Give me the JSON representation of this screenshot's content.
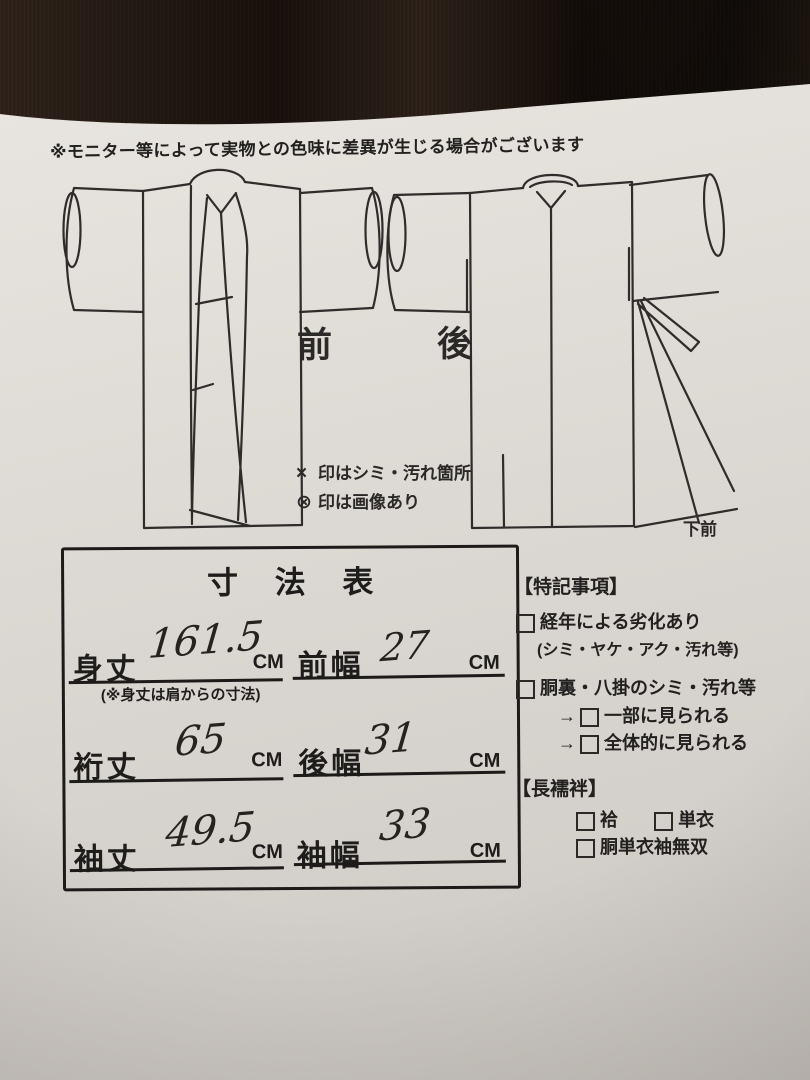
{
  "colors": {
    "paper": "#dedad5",
    "ink": "#222222",
    "fabric": "#241a14"
  },
  "disclaimer": "※モニター等によって実物との色味に差異が生じる場合がございます",
  "diagram": {
    "front_label": "前",
    "back_label": "後",
    "lower_front_label": "下前",
    "legend": [
      {
        "symbol": "×",
        "text": "印はシミ・汚れ箇所"
      },
      {
        "symbol": "⊗",
        "text": "印は画像あり"
      }
    ]
  },
  "size_table": {
    "title": "寸 法 表",
    "rows": [
      {
        "left_label": "身丈",
        "left_value": "161.5",
        "left_unit": "CM",
        "note": "(※身丈は肩からの寸法)",
        "right_label": "前幅",
        "right_value": "27",
        "right_unit": "CM"
      },
      {
        "left_label": "裄丈",
        "left_value": "65",
        "left_unit": "CM",
        "right_label": "後幅",
        "right_value": "31",
        "right_unit": "CM"
      },
      {
        "left_label": "袖丈",
        "left_value": "49.5",
        "left_unit": "CM",
        "right_label": "袖幅",
        "right_value": "33",
        "right_unit": "CM"
      }
    ]
  },
  "special_notes": {
    "title": "【特記事項】",
    "item1": {
      "label": "経年による劣化あり",
      "detail": "(シミ・ヤケ・アク・汚れ等)"
    },
    "item2": {
      "label": "胴裏・八掛のシミ・汚れ等",
      "options": [
        {
          "arrow": "→",
          "label": "一部に見られる"
        },
        {
          "arrow": "→",
          "label": "全体的に見られる"
        }
      ]
    }
  },
  "nagajuban": {
    "title": "【長襦袢】",
    "option1": "袷",
    "option2": "単衣",
    "option3": "胴単衣袖無双"
  }
}
